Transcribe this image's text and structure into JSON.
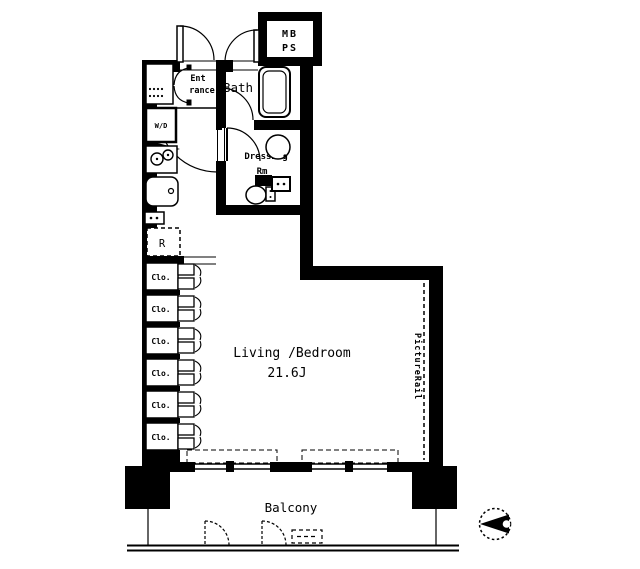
{
  "floorplan": {
    "colors": {
      "line": "#000000",
      "background": "#ffffff"
    },
    "meter_box": {
      "line1": "MB",
      "line2": "PS"
    },
    "entrance": {
      "line1": "Ent",
      "line2": "rance"
    },
    "bath": {
      "label": "Bath"
    },
    "washer_dryer": {
      "label": "W/D"
    },
    "dressing_room": {
      "line1": "Dressing",
      "line2": "Rm"
    },
    "kitchen": {
      "refrigerator": "R"
    },
    "closets": [
      {
        "label": "Clo."
      },
      {
        "label": "Clo."
      },
      {
        "label": "Clo."
      },
      {
        "label": "Clo."
      },
      {
        "label": "Clo."
      },
      {
        "label": "Clo."
      }
    ],
    "living_bedroom": {
      "name": "Living /Bedroom",
      "size": "21.6J"
    },
    "picture_rail": {
      "label": "PictureRail"
    },
    "balcony": {
      "label": "Balcony"
    },
    "compass": {
      "icon": "north-arrow-icon"
    }
  }
}
